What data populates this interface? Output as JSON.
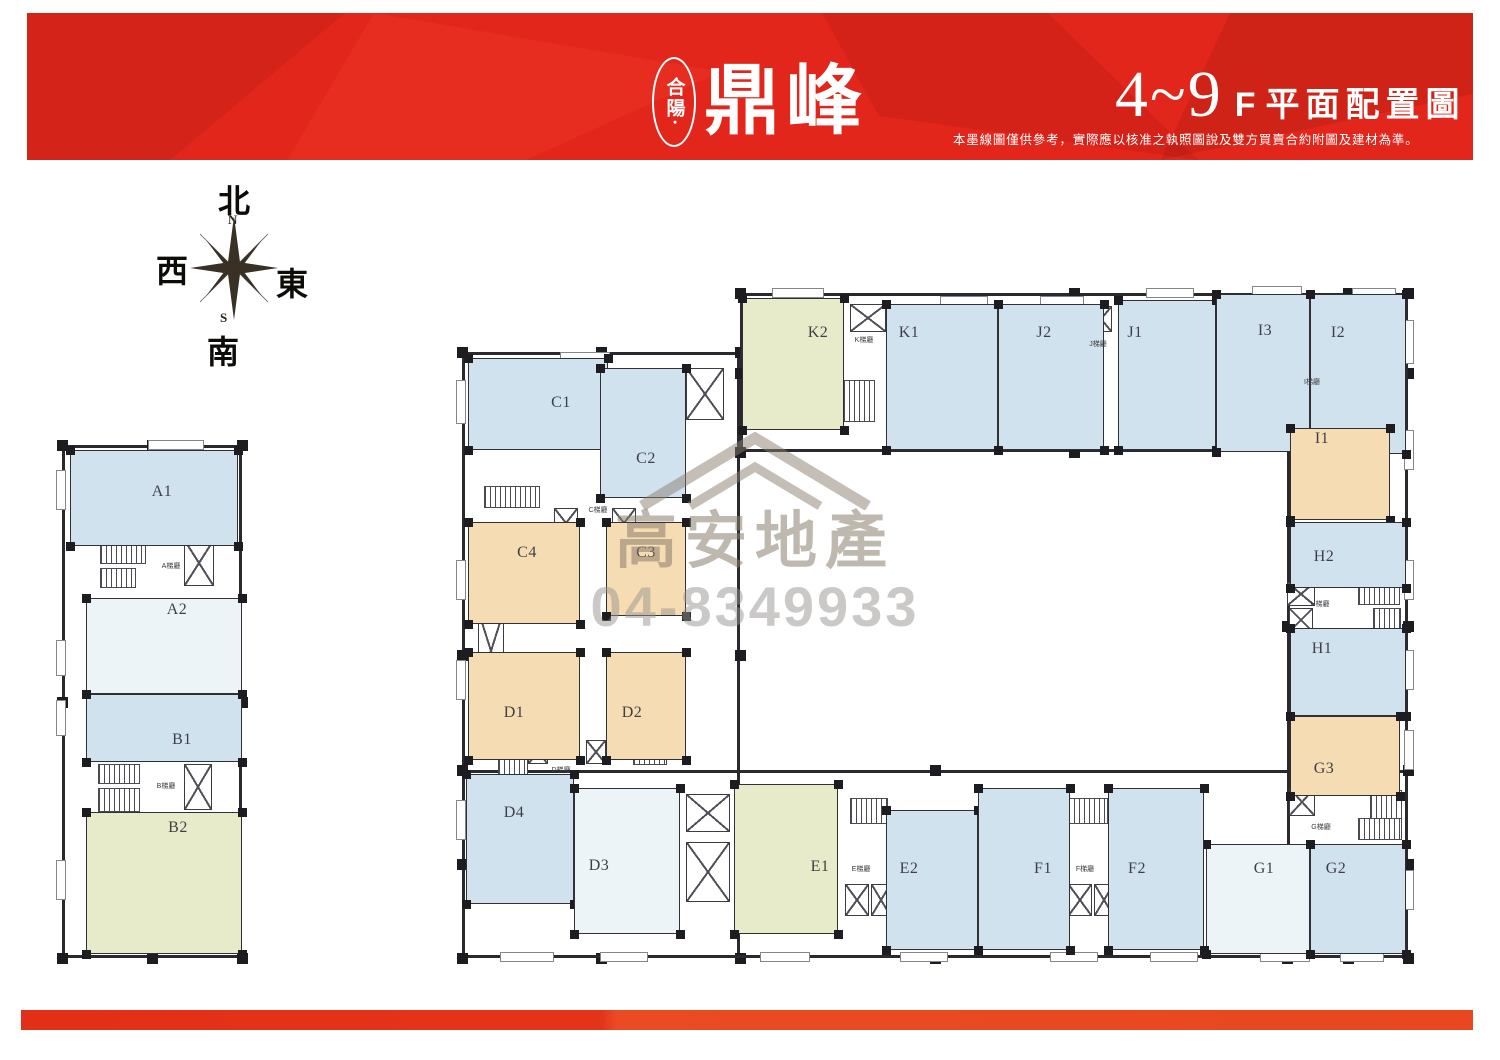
{
  "header": {
    "logo_prefix": "合陽·",
    "logo_main": "鼎峰",
    "floor_range": "4~9",
    "floor_suffix": "F",
    "title": "平面配置圖",
    "disclaimer": "本墨線圖僅供參考，實際應以核准之執照圖說及雙方買賣合約附圖及建材為準。"
  },
  "compass": {
    "north": "北",
    "south": "南",
    "east": "東",
    "west": "西",
    "n": "N",
    "s": "S"
  },
  "watermark": {
    "company": "高安地產",
    "phone": "04-8349933"
  },
  "palette": {
    "header_red": "#e2261b",
    "footer_red": "#e8391f",
    "wall": "#2a2a2e",
    "unit_blue": "#cfe2ee",
    "unit_pale": "#edf4f8",
    "unit_green": "#e8ebc9",
    "unit_tan": "#f6dcb2"
  },
  "plan": {
    "walls": [
      [
        62,
        445,
        180,
        513
      ],
      [
        462,
        352,
        278,
        606
      ],
      [
        740,
        293,
        668,
        159
      ],
      [
        1287,
        293,
        121,
        665
      ],
      [
        462,
        770,
        946,
        188
      ]
    ],
    "units": [
      {
        "label": "A1",
        "color": "blue",
        "rect": [
          70,
          450,
          168,
          96
        ],
        "lx": 162,
        "ly": 492
      },
      {
        "label": "A2",
        "color": "pale",
        "rect": [
          86,
          598,
          156,
          96
        ],
        "lx": 177,
        "ly": 610
      },
      {
        "label": "B1",
        "color": "blue",
        "rect": [
          86,
          694,
          156,
          68
        ],
        "lx": 182,
        "ly": 740
      },
      {
        "label": "B2",
        "color": "green",
        "rect": [
          86,
          812,
          156,
          142
        ],
        "lx": 178,
        "ly": 828
      },
      {
        "label": "C1",
        "color": "blue",
        "rect": [
          468,
          358,
          140,
          92
        ],
        "lx": 561,
        "ly": 403
      },
      {
        "label": "C2",
        "color": "blue",
        "rect": [
          600,
          368,
          86,
          130
        ],
        "lx": 646,
        "ly": 459
      },
      {
        "label": "C4",
        "color": "tan",
        "rect": [
          468,
          522,
          112,
          102
        ],
        "lx": 527,
        "ly": 553
      },
      {
        "label": "C3",
        "color": "tan",
        "rect": [
          606,
          522,
          80,
          94
        ],
        "lx": 646,
        "ly": 553
      },
      {
        "label": "D1",
        "color": "tan",
        "rect": [
          468,
          652,
          112,
          108
        ],
        "lx": 514,
        "ly": 713
      },
      {
        "label": "D2",
        "color": "tan",
        "rect": [
          606,
          652,
          80,
          108
        ],
        "lx": 632,
        "ly": 713
      },
      {
        "label": "D4",
        "color": "blue",
        "rect": [
          466,
          774,
          108,
          130
        ],
        "lx": 514,
        "ly": 813
      },
      {
        "label": "D3",
        "color": "pale",
        "rect": [
          574,
          788,
          106,
          146
        ],
        "lx": 599,
        "ly": 866
      },
      {
        "label": "K2",
        "color": "green",
        "rect": [
          742,
          298,
          102,
          132
        ],
        "lx": 818,
        "ly": 333
      },
      {
        "label": "K1",
        "color": "blue",
        "rect": [
          886,
          304,
          112,
          146
        ],
        "lx": 909,
        "ly": 333
      },
      {
        "label": "J2",
        "color": "blue",
        "rect": [
          998,
          304,
          106,
          146
        ],
        "lx": 1044,
        "ly": 333
      },
      {
        "label": "J1",
        "color": "blue",
        "rect": [
          1118,
          300,
          98,
          150
        ],
        "lx": 1135,
        "ly": 333
      },
      {
        "label": "I3",
        "color": "blue",
        "rect": [
          1216,
          294,
          94,
          158
        ],
        "lx": 1265,
        "ly": 331
      },
      {
        "label": "I2",
        "color": "blue",
        "rect": [
          1310,
          294,
          96,
          160
        ],
        "lx": 1338,
        "ly": 333
      },
      {
        "label": "I1",
        "color": "tan",
        "rect": [
          1290,
          428,
          100,
          92
        ],
        "lx": 1322,
        "ly": 439
      },
      {
        "label": "H2",
        "color": "blue",
        "rect": [
          1290,
          522,
          116,
          66
        ],
        "lx": 1324,
        "ly": 557
      },
      {
        "label": "H1",
        "color": "blue",
        "rect": [
          1290,
          628,
          116,
          88
        ],
        "lx": 1322,
        "ly": 649
      },
      {
        "label": "G3",
        "color": "tan",
        "rect": [
          1290,
          716,
          110,
          80
        ],
        "lx": 1324,
        "ly": 769
      },
      {
        "label": "G1",
        "color": "pale",
        "rect": [
          1206,
          844,
          104,
          110
        ],
        "lx": 1264,
        "ly": 869
      },
      {
        "label": "G2",
        "color": "blue",
        "rect": [
          1310,
          844,
          96,
          110
        ],
        "lx": 1336,
        "ly": 869
      },
      {
        "label": "E1",
        "color": "green",
        "rect": [
          734,
          784,
          104,
          150
        ],
        "lx": 820,
        "ly": 867
      },
      {
        "label": "E2",
        "color": "blue",
        "rect": [
          886,
          810,
          92,
          140
        ],
        "lx": 909,
        "ly": 869
      },
      {
        "label": "F1",
        "color": "blue",
        "rect": [
          978,
          788,
          92,
          162
        ],
        "lx": 1043,
        "ly": 869
      },
      {
        "label": "F2",
        "color": "blue",
        "rect": [
          1108,
          788,
          96,
          162
        ],
        "lx": 1137,
        "ly": 869
      }
    ],
    "cores": [
      {
        "label": "A梯廳",
        "x": 171,
        "y": 566
      },
      {
        "label": "B梯廳",
        "x": 166,
        "y": 786
      },
      {
        "label": "C梯廳",
        "x": 598,
        "y": 510
      },
      {
        "label": "D梯廳",
        "x": 561,
        "y": 770
      },
      {
        "label": "E梯廳",
        "x": 861,
        "y": 869
      },
      {
        "label": "F梯廳",
        "x": 1085,
        "y": 869
      },
      {
        "label": "G梯廳",
        "x": 1321,
        "y": 827
      },
      {
        "label": "H梯廳",
        "x": 1320,
        "y": 604
      },
      {
        "label": "I梯廳",
        "x": 1312,
        "y": 382
      },
      {
        "label": "J梯廳",
        "x": 1098,
        "y": 344
      },
      {
        "label": "K梯廳",
        "x": 864,
        "y": 340
      }
    ],
    "shafts": [
      [
        184,
        540,
        30,
        46
      ],
      [
        184,
        764,
        28,
        46
      ],
      [
        554,
        508,
        24,
        30
      ],
      [
        612,
        508,
        24,
        30
      ],
      [
        686,
        368,
        38,
        52
      ],
      [
        478,
        612,
        26,
        78
      ],
      [
        528,
        740,
        20,
        24
      ],
      [
        586,
        740,
        20,
        24
      ],
      [
        686,
        794,
        44,
        38
      ],
      [
        686,
        842,
        44,
        60
      ],
      [
        845,
        884,
        24,
        32
      ],
      [
        871,
        884,
        20,
        32
      ],
      [
        1068,
        884,
        24,
        32
      ],
      [
        1094,
        884,
        20,
        32
      ],
      [
        1289,
        788,
        26,
        28
      ],
      [
        1287,
        582,
        28,
        24
      ],
      [
        1289,
        608,
        24,
        24
      ],
      [
        1288,
        395,
        30,
        28
      ],
      [
        1064,
        306,
        24,
        26
      ],
      [
        1090,
        306,
        22,
        26
      ],
      [
        850,
        304,
        36,
        28
      ]
    ],
    "stairs": [
      [
        100,
        542,
        46,
        22
      ],
      [
        100,
        568,
        36,
        20
      ],
      [
        98,
        764,
        42,
        20
      ],
      [
        98,
        788,
        42,
        24
      ],
      [
        484,
        486,
        56,
        22
      ],
      [
        498,
        746,
        30,
        36
      ],
      [
        633,
        745,
        34,
        20
      ],
      [
        843,
        380,
        32,
        42
      ],
      [
        1066,
        377,
        36,
        44
      ],
      [
        1353,
        374,
        44,
        20
      ],
      [
        1370,
        398,
        30,
        22
      ],
      [
        1358,
        583,
        42,
        22
      ],
      [
        1373,
        608,
        28,
        22
      ],
      [
        1370,
        790,
        32,
        30
      ],
      [
        1358,
        818,
        44,
        22
      ],
      [
        850,
        798,
        38,
        26
      ],
      [
        1068,
        798,
        40,
        26
      ]
    ],
    "balconies": [
      [
        148,
        440,
        56,
        10
      ],
      [
        56,
        470,
        10,
        40
      ],
      [
        56,
        640,
        10,
        36
      ],
      [
        56,
        700,
        10,
        36
      ],
      [
        56,
        860,
        10,
        40
      ],
      [
        560,
        352,
        50,
        10
      ],
      [
        456,
        380,
        10,
        44
      ],
      [
        456,
        560,
        10,
        40
      ],
      [
        456,
        660,
        10,
        40
      ],
      [
        456,
        800,
        10,
        40
      ],
      [
        772,
        288,
        52,
        10
      ],
      [
        940,
        296,
        48,
        10
      ],
      [
        1040,
        296,
        44,
        10
      ],
      [
        1146,
        288,
        48,
        10
      ],
      [
        1252,
        286,
        50,
        10
      ],
      [
        1352,
        288,
        44,
        10
      ],
      [
        1404,
        320,
        10,
        44
      ],
      [
        1404,
        430,
        10,
        40
      ],
      [
        1404,
        560,
        10,
        40
      ],
      [
        1404,
        650,
        10,
        40
      ],
      [
        1404,
        730,
        10,
        40
      ],
      [
        1404,
        870,
        10,
        40
      ],
      [
        500,
        952,
        54,
        10
      ],
      [
        600,
        952,
        48,
        10
      ],
      [
        760,
        952,
        50,
        10
      ],
      [
        900,
        952,
        48,
        10
      ],
      [
        1050,
        952,
        48,
        10
      ],
      [
        1150,
        952,
        48,
        10
      ],
      [
        1260,
        952,
        50,
        10
      ],
      [
        1340,
        952,
        44,
        10
      ]
    ]
  }
}
